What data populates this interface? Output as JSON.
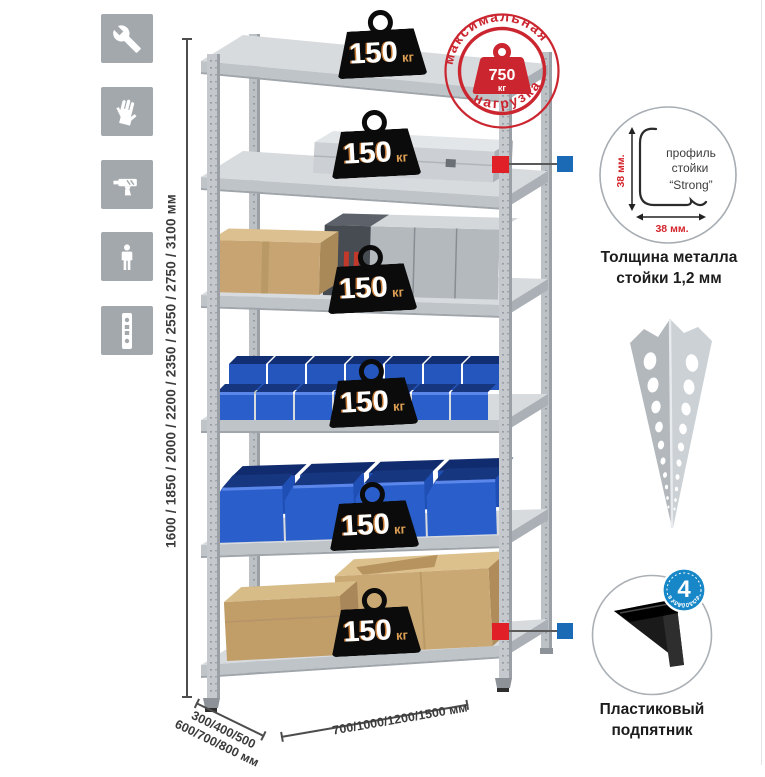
{
  "sidebar": {
    "icons": [
      {
        "name": "wrench-icon"
      },
      {
        "name": "gloves-icon"
      },
      {
        "name": "drill-icon"
      },
      {
        "name": "person-icon"
      },
      {
        "name": "rack-post-icon"
      }
    ]
  },
  "dimensions": {
    "height": "1600 / 1850 / 2000 / 2200 / 2350 / 2550 / 2750 / 3100 мм",
    "depth_line1": "300/400/500",
    "depth_line2": "600/700/800 мм",
    "width": "700/1000/1200/1500 мм"
  },
  "rack": {
    "shelf_badges": [
      {
        "value": "150",
        "unit": "кг"
      },
      {
        "value": "150",
        "unit": "кг"
      },
      {
        "value": "150",
        "unit": "кг"
      },
      {
        "value": "150",
        "unit": "кг"
      },
      {
        "value": "150",
        "unit": "кг"
      },
      {
        "value": "150",
        "unit": "кг"
      }
    ]
  },
  "stamp": {
    "arc_top": "максимальная",
    "arc_bottom": "нагрузка",
    "value": "750",
    "unit": "кг"
  },
  "profile_callout": {
    "label_line1": "профиль",
    "label_line2": "стойки",
    "label_line3": "“Strong”",
    "dim_vertical": "38 мм.",
    "dim_horizontal": "38 мм.",
    "caption_line1": "Толщина металла",
    "caption_line2": "стойки 1,2 мм"
  },
  "foot_callout": {
    "badge_value": "4",
    "badge_arc": "в комплекте",
    "caption_line1": "Пластиковый",
    "caption_line2": "подпятник"
  },
  "colors": {
    "stamp_red": "#cb2630",
    "connector_red": "#e01f26",
    "connector_blue": "#1a6ab5",
    "foot_badge_blue": "#1787c8",
    "bin_blue": "#2a5ecb",
    "metal_gray": "#c7cbcf",
    "cardboard": "#c9a876",
    "icon_tile_gray": "#a3a8ac"
  }
}
